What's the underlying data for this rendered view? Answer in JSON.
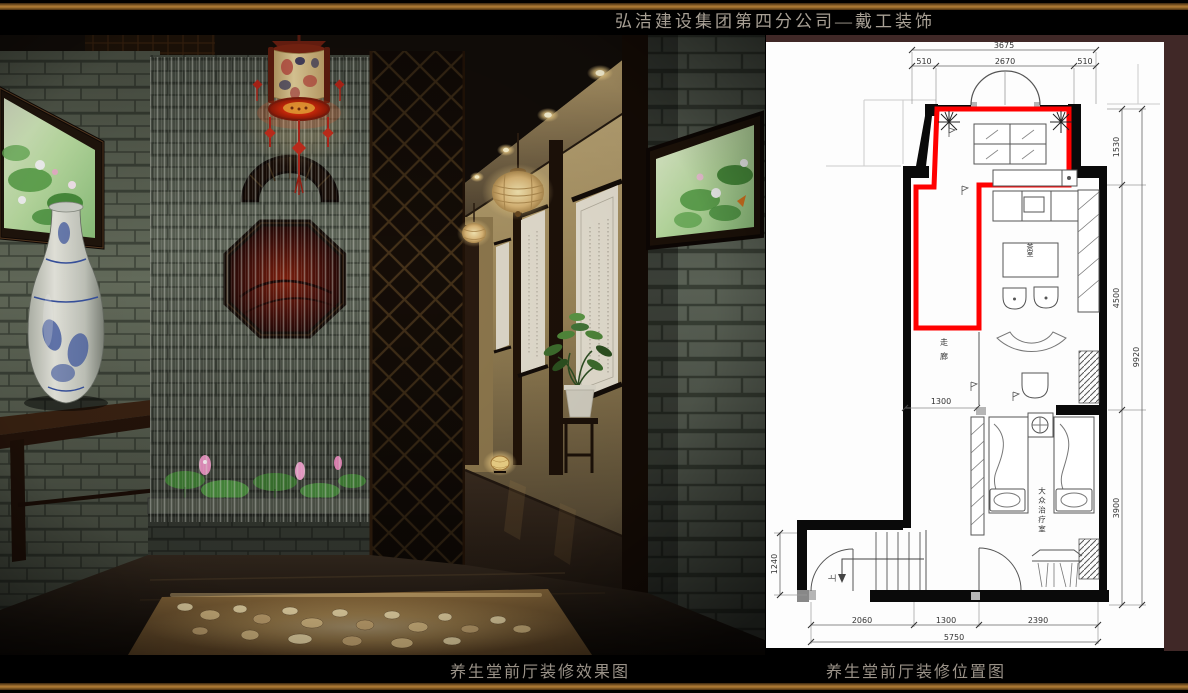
{
  "header": {
    "title": "弘洁建设集团第四分公司—戴工装饰"
  },
  "captions": {
    "render": "养生堂前厅装修效果图",
    "plan": "养生堂前厅装修位置图"
  },
  "colors": {
    "border_bronze": "#8a5a20",
    "plan_frame_maroon": "#402827",
    "highlight_red": "#ff0000",
    "paper": "#fdfdfd",
    "background": "#000000"
  },
  "floor_plan": {
    "room_labels": {
      "tea_room": "茶室",
      "corridor": "走廊",
      "treatment_room": "大众治疗室",
      "stairs_up": "上"
    },
    "dimensions": {
      "top_total": "3675",
      "top_segments": [
        "510",
        "2670",
        "510"
      ],
      "right_segments": [
        "1530",
        "4500",
        "3900"
      ],
      "right_total": "9920",
      "left_side": "1240",
      "interior_width": "1300",
      "bottom_segments": [
        "2060",
        "1300",
        "2390"
      ],
      "bottom_total": "5750"
    }
  }
}
